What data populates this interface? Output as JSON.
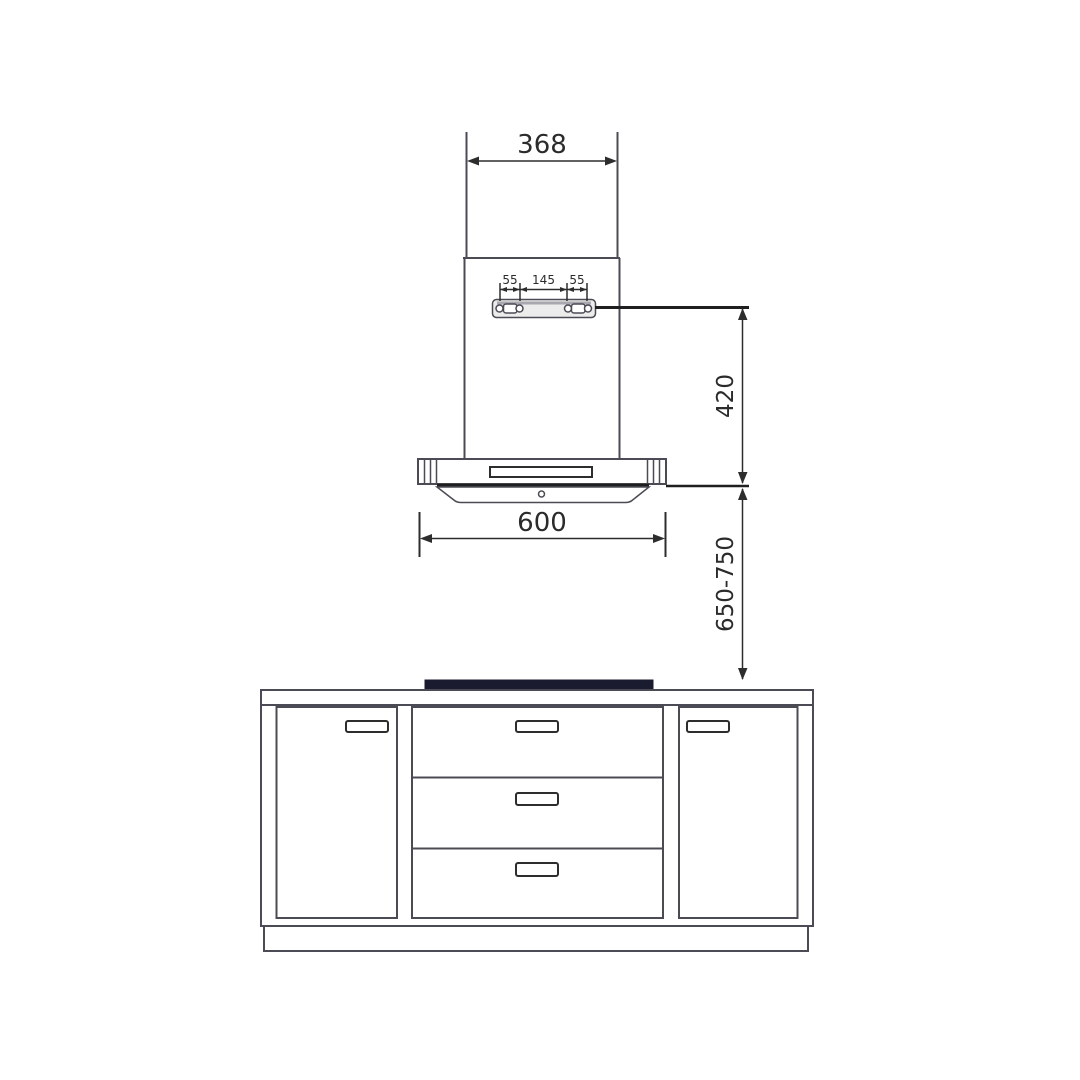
{
  "page": {
    "background": "#ffffff",
    "kind": "range-hood-installation-drawing"
  },
  "colors": {
    "line-color": "#4b4b55",
    "dim-color": "#2d2d2d",
    "ref-color": "#1f1f1f",
    "bracket-fill": "#ececec",
    "bracket-shade": "#a8a8ae",
    "cooktop-color": "#1b1b30",
    "dim-text": "#2b2b2b",
    "bg": "#ffffff"
  },
  "dimensions": {
    "duct_width": "368",
    "bracket_pitch_left": "55",
    "bracket_pitch_center": "145",
    "bracket_pitch_right": "55",
    "hood_body_height": "420",
    "hood_width": "600",
    "install_height_range": "650-750"
  }
}
